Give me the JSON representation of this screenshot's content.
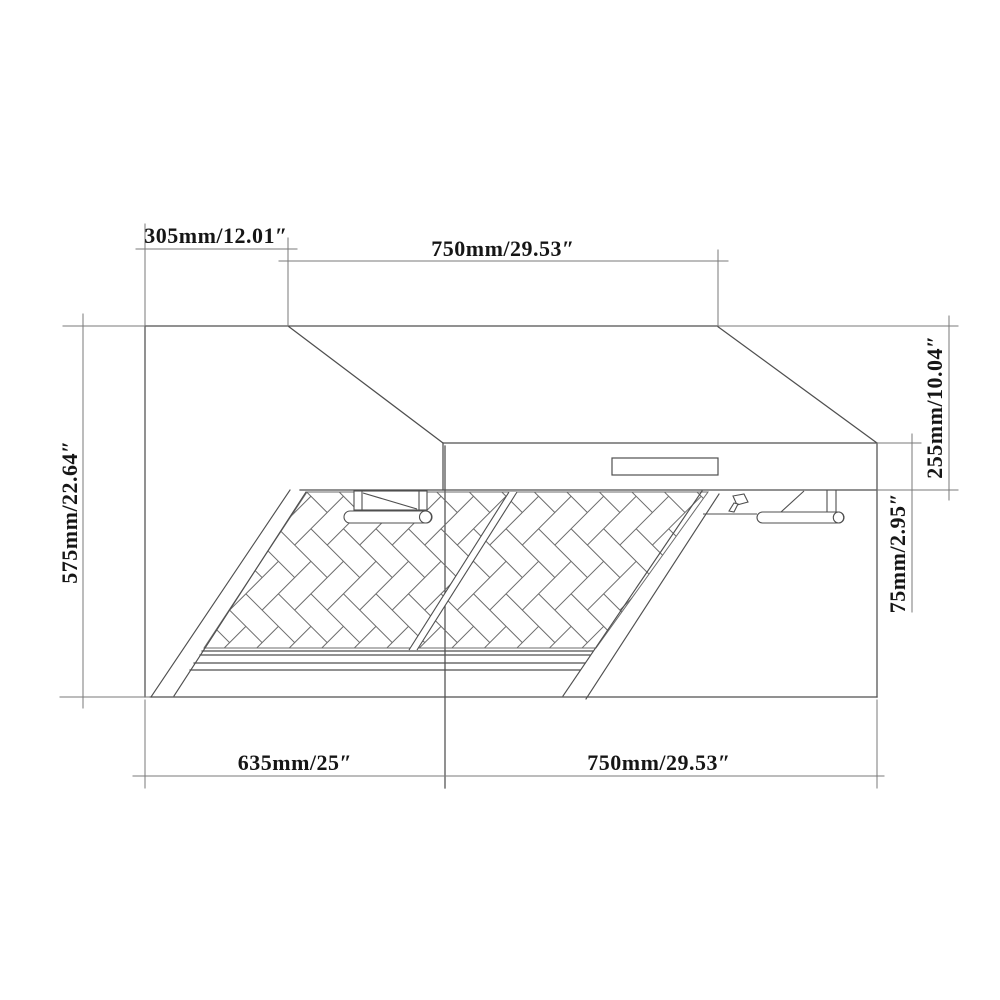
{
  "diagram": {
    "type": "technical-drawing",
    "subject": "Wall-mount range hood dimension diagram, front perspective view with two baffle filters, handles and control panel",
    "background_color": "#ffffff",
    "line_color": "#4f4f4f",
    "pattern_line_color": "#6b6b6b",
    "dimension_line_color": "#7a7a7a",
    "text_color": "#161616",
    "dimensions": {
      "top_left": {
        "label": "305mm/12.01″",
        "orientation": "horizontal",
        "measures": "chimney offset depth"
      },
      "top_center": {
        "label": "750mm/29.53″",
        "orientation": "horizontal",
        "measures": "top width"
      },
      "left": {
        "label": "575mm/22.64″",
        "orientation": "vertical",
        "measures": "overall height"
      },
      "right_upper": {
        "label": "255mm/10.04″",
        "orientation": "vertical",
        "measures": "body height"
      },
      "right_lower": {
        "label": "75mm/2.95″",
        "orientation": "vertical",
        "measures": "front panel height"
      },
      "bottom_left": {
        "label": "635mm/25″",
        "orientation": "horizontal",
        "measures": "bottom depth"
      },
      "bottom_right": {
        "label": "750mm/29.53″",
        "orientation": "horizontal",
        "measures": "bottom width"
      }
    }
  }
}
